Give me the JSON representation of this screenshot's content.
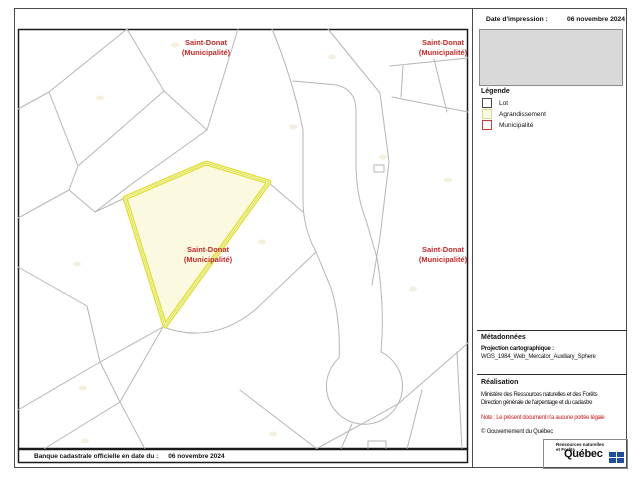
{
  "header": {
    "date_label": "Date d'impression :",
    "date_value": "06 novembre 2024"
  },
  "legend": {
    "title": "Légende",
    "items": [
      {
        "label": "Lot",
        "fill": "#ffffff",
        "border": "#4a4a4a"
      },
      {
        "label": "Agrandissement",
        "fill": "#fdfce8",
        "border": "#d9dc8e"
      },
      {
        "label": "Municipalité",
        "fill": "#ffffff",
        "border": "#c23b3b"
      }
    ]
  },
  "metadata": {
    "title": "Métadonnées",
    "projection_label": "Projection cartographique :",
    "projection_value": "WGS_1984_Web_Mercator_Auxiliary_Sphere"
  },
  "realisation": {
    "title": "Réalisation",
    "line1": "Ministère des Ressources naturelles et des Forêts",
    "line2": "Direction générale de l'arpentage et du cadastre",
    "note": "Note : Le présent document n'a aucune portée légale",
    "copyright": "© Gouvernement du Québec"
  },
  "logo": {
    "dept_line1": "Ressources naturelles",
    "dept_line2": "et Forêts",
    "wordmark": "Québec",
    "flag_color": "#1f4e9c"
  },
  "footer": {
    "label": "Banque cadastrale officielle en date du :",
    "value": "06 novembre 2024"
  },
  "map": {
    "highlight": {
      "name": "Saint-Donat (Municipalité)",
      "fill": "#fbfae1",
      "stroke": "#e0e040"
    },
    "colors": {
      "parcel_line": "#b6b6b6",
      "label_red": "#c02b2b"
    },
    "labels": [
      {
        "line1": "Saint-Donat",
        "line2": "(Municipalité)"
      },
      {
        "line1": "Saint-Donat",
        "line2": "(Municipalité)"
      },
      {
        "line1": "Saint-Donat",
        "line2": "(Municipalité)"
      },
      {
        "line1": "Saint-Donat",
        "line2": "(Municipalité)"
      }
    ]
  }
}
